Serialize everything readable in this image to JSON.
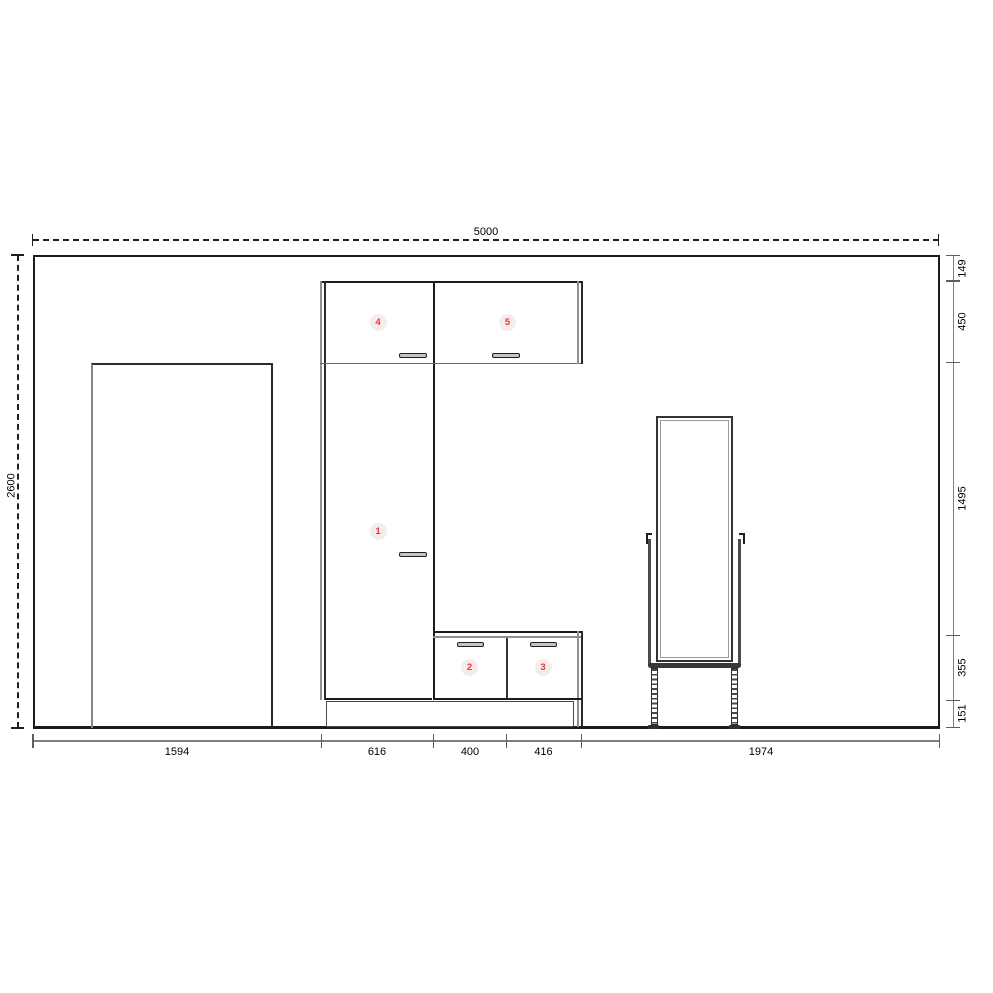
{
  "dimensions": {
    "total_width_mm": "5000",
    "total_height_mm": "2600",
    "right_segments": [
      "149",
      "450",
      "1495",
      "355",
      "151"
    ],
    "bottom_segments": [
      "1594",
      "616",
      "400",
      "416",
      "1974"
    ]
  },
  "item_labels": [
    "1",
    "2",
    "3",
    "4",
    "5"
  ],
  "colors": {
    "outline": "#1b1b1b",
    "secondary_line": "#8a8a8a",
    "dimension_line": "#808080",
    "item_number": "#e53935",
    "item_badge_bg": "#f7ecec",
    "background": "#ffffff"
  }
}
